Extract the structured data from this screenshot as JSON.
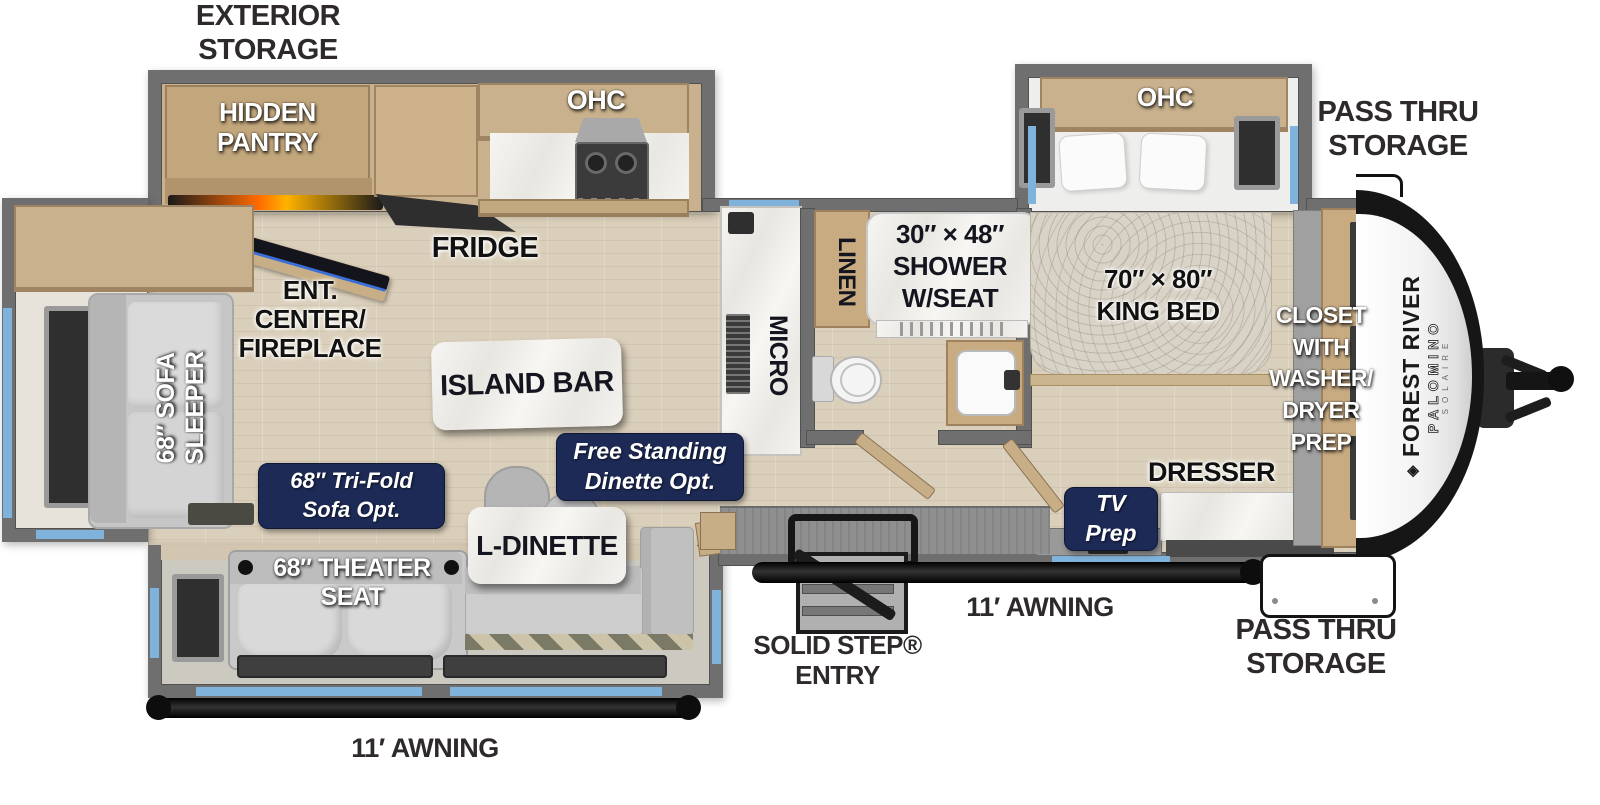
{
  "title_labels": {
    "exterior_storage": "EXTERIOR\nSTORAGE",
    "pass_thru_top": "PASS THRU\nSTORAGE",
    "pass_thru_bottom": "PASS THRU\nSTORAGE",
    "awning_left": "11′ AWNING",
    "awning_right": "11′ AWNING",
    "solid_step": "SOLID STEP®\nENTRY"
  },
  "rooms": {
    "hidden_pantry": "HIDDEN\nPANTRY",
    "ohc_kitchen": "OHC",
    "ohc_bedroom": "OHC",
    "fridge": "FRIDGE",
    "ent_center": "ENT.\nCENTER/\nFIREPLACE",
    "micro": "MICRO",
    "linen": "LINEN",
    "shower": "30″ × 48″\nSHOWER\nW/SEAT",
    "king_bed": "70″ × 80″\nKING BED",
    "closet": "CLOSET\nWITH\nWASHER/\nDRYER\nPREP",
    "island_bar": "ISLAND BAR",
    "sofa_sleeper": "68″ SOFA\nSLEEPER",
    "l_dinette": "L-DINETTE",
    "theater_seat": "68″ THEATER\nSEAT",
    "dresser": "DRESSER"
  },
  "badges": {
    "trifold_sofa": "68″ Tri-Fold\nSofa Opt.",
    "freestanding_dinette": "Free Standing\nDinette Opt.",
    "tv_prep": "TV\nPrep"
  },
  "brand": {
    "logo_glyph": "◈",
    "make": "FOREST RIVER",
    "model": "PALOMINO",
    "trim": "SOLAIRE"
  },
  "colors": {
    "navy": "#1d2a56",
    "wall": "#6f6f6f",
    "floor": "#dacfba",
    "cabinet": "#c8b18c",
    "blue": "#7fb3dc",
    "charcoal": "#2e2a2b"
  }
}
